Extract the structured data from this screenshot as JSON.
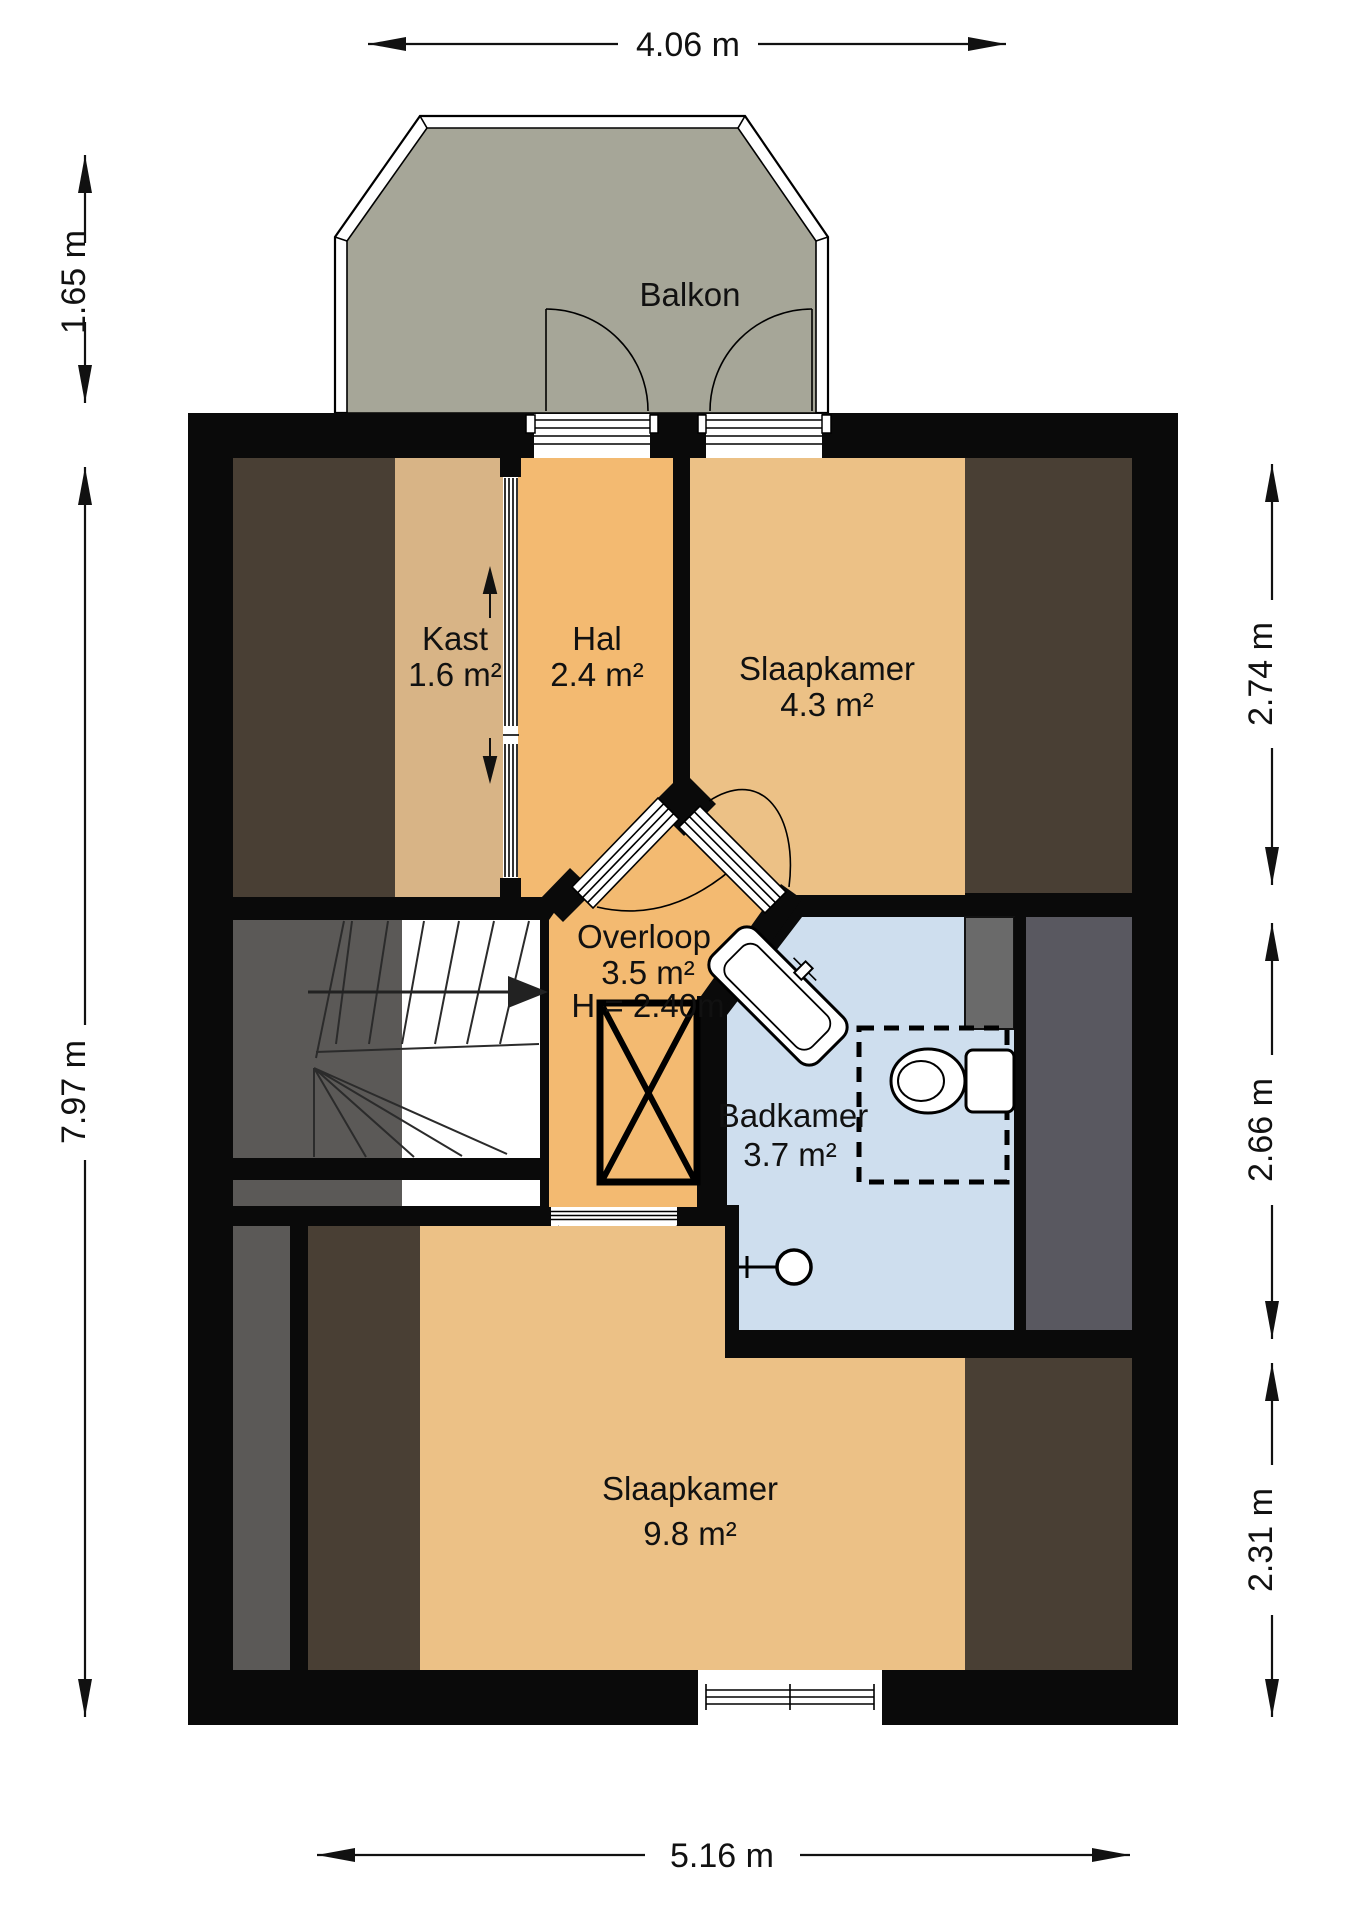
{
  "floorplan": {
    "rooms": {
      "balkon": {
        "label": "Balkon"
      },
      "kast": {
        "label": "Kast",
        "area": "1.6 m²"
      },
      "hal": {
        "label": "Hal",
        "area": "2.4 m²"
      },
      "slaapkamer_voor": {
        "label": "Slaapkamer",
        "area": "4.3 m²"
      },
      "overloop": {
        "label": "Overloop",
        "area": "3.5 m²",
        "height": "H = 2.40m"
      },
      "badkamer": {
        "label": "Badkamer",
        "area": "3.7 m²"
      },
      "slaapkamer_achter": {
        "label": "Slaapkamer",
        "area": "9.8 m²"
      }
    },
    "dimensions": {
      "top": "4.06 m",
      "balcony_depth": "1.65 m",
      "left": "7.97 m",
      "right_top": "2.74 m",
      "right_middle": "2.66 m",
      "right_bottom": "2.31 m",
      "bottom": "5.16 m"
    },
    "colors": {
      "wall": "#0a0a0a",
      "floor": "#f3ba71",
      "floor_light": "#ecc186",
      "floor_tan": "#d8b486",
      "bathroom": "#cedeee",
      "balcony": "#a6a698",
      "slope_dark": "#493f34",
      "slope_gray": "#595860",
      "stair_gray": "#5b5957"
    }
  }
}
